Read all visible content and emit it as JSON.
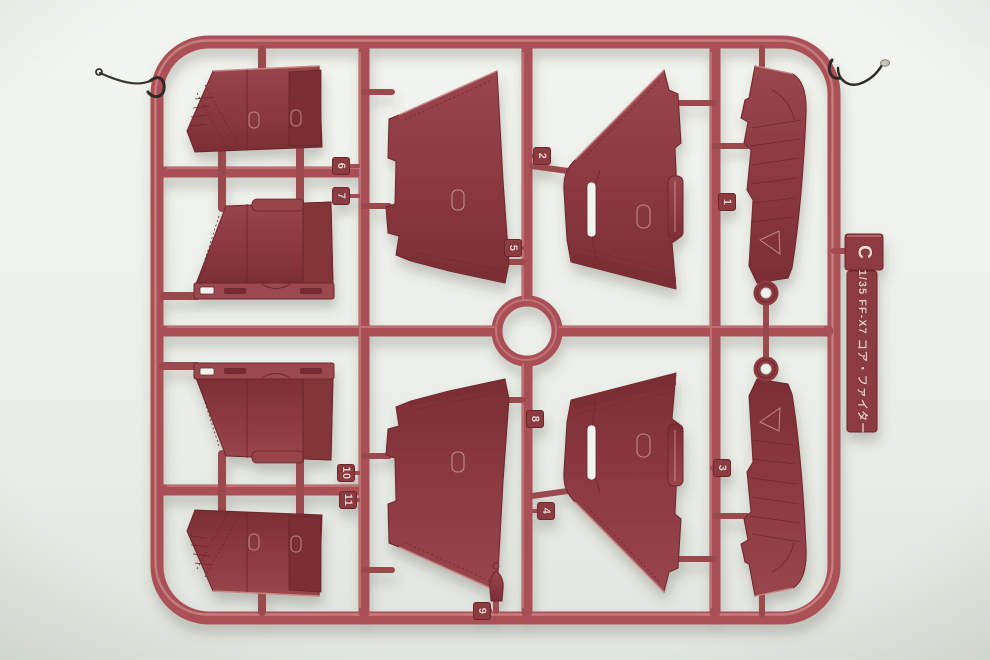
{
  "scene": {
    "colors": {
      "background": "#eef1ec",
      "background_bottom": "#e1e6e0",
      "runner": "#ab5156",
      "runner_highlight": "#d2908d",
      "part": "#8c3a41",
      "part_dark": "#7c2f35",
      "part_line": "#6e262c",
      "part_light_edge": "#c98582",
      "detail_outline": "#bf8a86",
      "slot_through_hole": "#f2f4ef",
      "wire": "#2e2a26",
      "wire_crimp": "#c8c2b4",
      "string": "#f7f7f2",
      "emboss_text": "#ecd6d1"
    }
  },
  "sprue": {
    "gate_letter": "C",
    "label_text": "1/35 FF-X7 コア・ファイター",
    "part_tags": [
      {
        "label": "1"
      },
      {
        "label": "2"
      },
      {
        "label": "3"
      },
      {
        "label": "4"
      },
      {
        "label": "5"
      },
      {
        "label": "6"
      },
      {
        "label": "7"
      },
      {
        "label": "8"
      },
      {
        "label": "9"
      },
      {
        "label": "10"
      },
      {
        "label": "11"
      }
    ]
  }
}
